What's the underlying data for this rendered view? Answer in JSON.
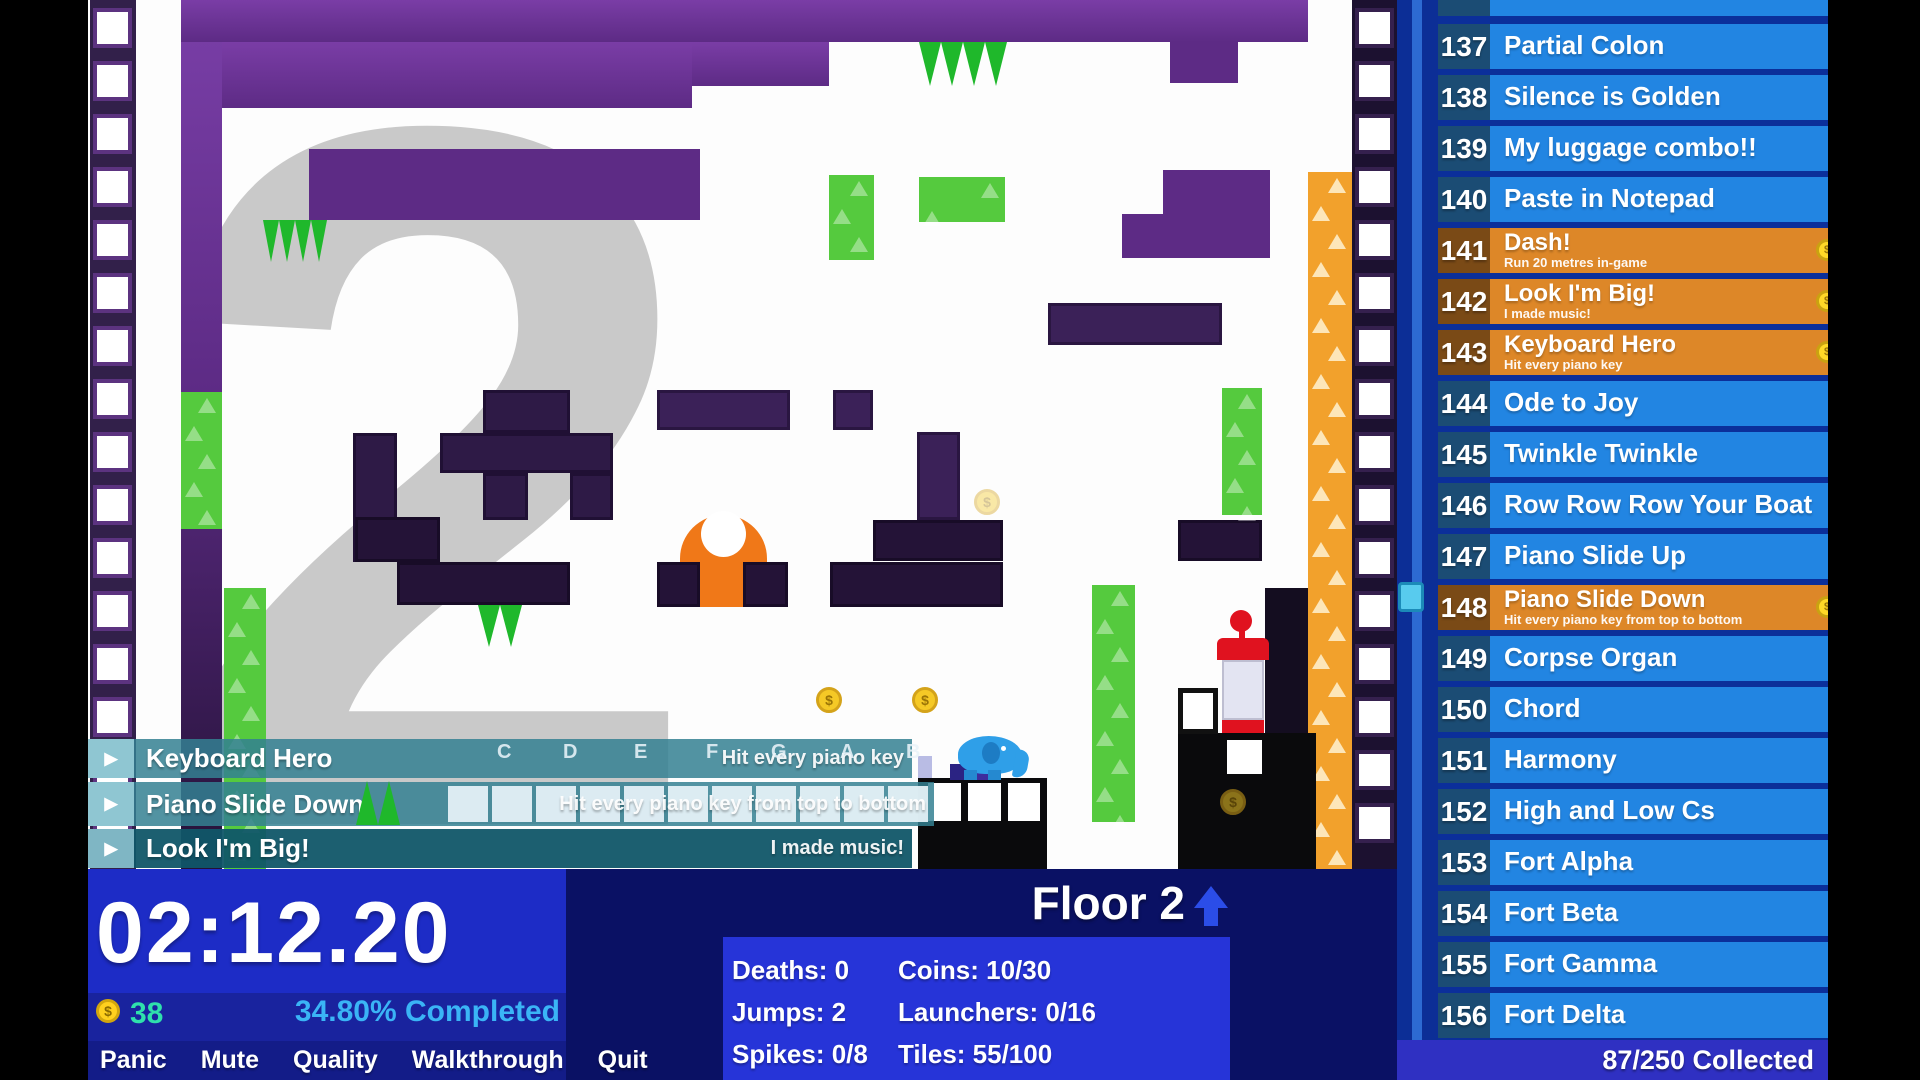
{
  "colors": {
    "row_blue": "#2285e2",
    "row_number_navy": "#1b4c74",
    "completed_orange": "#dd8728",
    "completed_number_brown": "#7a4a16",
    "sidebar_footer_blue": "#2f30c2",
    "hud_blue": "#1d2cc6",
    "hud_navy": "#0a1164",
    "stats_blue": "#2634d8",
    "completed_percent_text": "#3ab4f6",
    "coin_count_text": "#2fe0ac",
    "coin_yellow": "#ffd01e",
    "banner_teal": "rgba(52,128,146,0.85)",
    "platform_purple": "#5d2b85",
    "maze_dark_purple": "#2e1a46",
    "spike_green": "#1fb82b",
    "pillar_green": "#55ca3e",
    "launcher_orange": "#f2a12c",
    "numeral_gray": "#c9c9c9",
    "elephant_blue": "#2f9fe8",
    "device_red": "#e0121f"
  },
  "game": {
    "background_numeral": "2",
    "coin_symbol": "$",
    "piano_letters": [
      "C",
      "D",
      "E",
      "F",
      "G",
      "A",
      "B"
    ]
  },
  "banners": {
    "play_icon": "▶",
    "items": [
      {
        "title": "Keyboard Hero",
        "desc": "Hit every piano key"
      },
      {
        "title": "Piano Slide Down",
        "desc": "Hit every piano key from top to bottom"
      },
      {
        "title": "Look I'm Big!",
        "desc": "I made music!"
      }
    ]
  },
  "hud": {
    "timer": "02:12.20",
    "coin_count": "38",
    "completed": "34.80% Completed",
    "menu": [
      "Panic",
      "Mute",
      "Quality",
      "Walkthrough",
      "Quit"
    ],
    "floor_label": "Floor 2",
    "stats_left": [
      "Deaths: 0",
      "Jumps: 2",
      "Spikes: 0/8"
    ],
    "stats_right": [
      "Coins: 10/30",
      "Launchers: 0/16",
      "Tiles: 55/100"
    ]
  },
  "sidebar": {
    "footer": "87/250 Collected",
    "items": [
      {
        "num": "137",
        "title": "Partial Colon"
      },
      {
        "num": "138",
        "title": "Silence is Golden"
      },
      {
        "num": "139",
        "title": "My luggage combo!!"
      },
      {
        "num": "140",
        "title": "Paste in Notepad"
      },
      {
        "num": "141",
        "title": "Dash!",
        "desc": "Run 20 metres in-game",
        "completed": true
      },
      {
        "num": "142",
        "title": "Look I'm Big!",
        "desc": "I made music!",
        "completed": true
      },
      {
        "num": "143",
        "title": "Keyboard Hero",
        "desc": "Hit every piano key",
        "completed": true
      },
      {
        "num": "144",
        "title": "Ode to Joy"
      },
      {
        "num": "145",
        "title": "Twinkle Twinkle"
      },
      {
        "num": "146",
        "title": "Row Row Row Your Boat"
      },
      {
        "num": "147",
        "title": "Piano Slide Up"
      },
      {
        "num": "148",
        "title": "Piano Slide Down",
        "desc": "Hit every piano key from top to bottom",
        "completed": true
      },
      {
        "num": "149",
        "title": "Corpse Organ"
      },
      {
        "num": "150",
        "title": "Chord"
      },
      {
        "num": "151",
        "title": "Harmony"
      },
      {
        "num": "152",
        "title": "High and Low Cs"
      },
      {
        "num": "153",
        "title": "Fort Alpha"
      },
      {
        "num": "154",
        "title": "Fort Beta"
      },
      {
        "num": "155",
        "title": "Fort Gamma"
      },
      {
        "num": "156",
        "title": "Fort Delta"
      }
    ]
  }
}
